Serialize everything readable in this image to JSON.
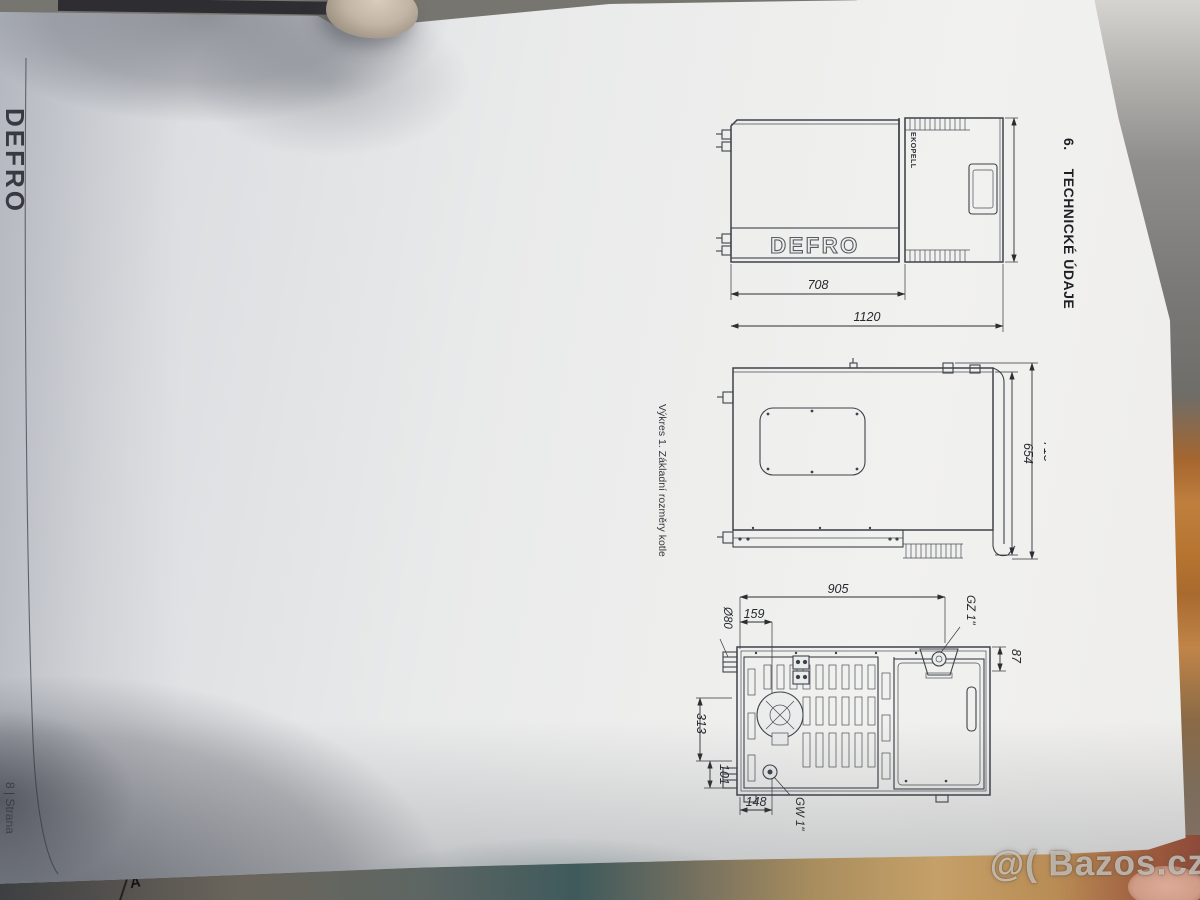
{
  "photo": {
    "watermark": "@( Bazos.cz",
    "under_page_mark": "A"
  },
  "page": {
    "brand_logo": "DEFRO",
    "heading_number": "6.",
    "heading_title": "TECHNICKÉ ÚDAJE",
    "caption": "Výkres 1. Základní rozměry kotle",
    "page_number": "8 | Strana"
  },
  "drawings": {
    "side_view": {
      "brand_plate": "DEFRO",
      "model_label": "EKOPELL",
      "dim_width_front": "708",
      "dim_width_total": "1120",
      "dim_height": "525"
    },
    "top_view": {
      "dim_depth_body": "654",
      "dim_depth_total": "715"
    },
    "rear_view": {
      "dim_width_total": "905",
      "dim_flue_offset": "159",
      "dim_flue_diameter": "Ø80",
      "label_supply_fitting": "GZ 1\"",
      "dim_fitting_offset": "87",
      "dim_height_mid": "313",
      "dim_height_lower": "101",
      "dim_return_offset": "148",
      "label_return_fitting": "GW 1\""
    }
  }
}
